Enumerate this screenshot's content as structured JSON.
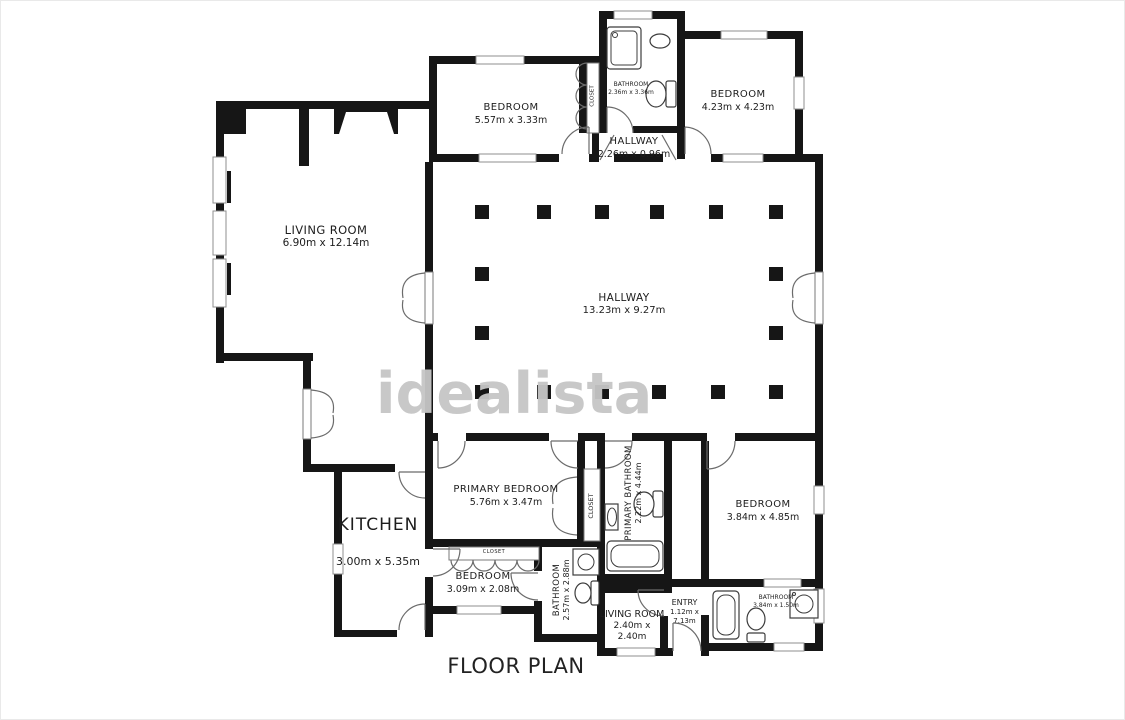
{
  "title": "FLOOR PLAN",
  "watermark": "idealista",
  "colors": {
    "wall": "#161616",
    "watermark": "#c6c6c6",
    "text": "#1d1d1d"
  },
  "rooms": {
    "living_room": {
      "name": "LIVING ROOM",
      "dims": "6.90m x 12.14m"
    },
    "bedroom_top": {
      "name": "BEDROOM",
      "dims": "5.57m x 3.33m"
    },
    "bathroom_top": {
      "name": "BATHROOM",
      "dims": "2.36m x 3.36m"
    },
    "closet_top": {
      "name": "CLOSET"
    },
    "hallway_top": {
      "name": "HALLWAY",
      "dims": "2.26m x 0.96m"
    },
    "bedroom_top_right": {
      "name": "BEDROOM",
      "dims": "4.23m x 4.23m"
    },
    "hallway_main": {
      "name": "HALLWAY",
      "dims": "13.23m x 9.27m"
    },
    "kitchen": {
      "name": "KITCHEN",
      "dims": "3.00m x 5.35m"
    },
    "primary_bedroom": {
      "name": "PRIMARY BEDROOM",
      "dims": "5.76m x 3.47m"
    },
    "closet_primary": {
      "name": "CLOSET"
    },
    "primary_bathroom": {
      "name": "PRIMARY BATHROOM",
      "dims": "2.22m x 4.44m"
    },
    "bedroom_right": {
      "name": "BEDROOM",
      "dims": "3.84m x 4.85m"
    },
    "closet_bedroom": {
      "name": "CLOSET"
    },
    "bedroom_small": {
      "name": "BEDROOM",
      "dims": "3.09m x 2.08m"
    },
    "bathroom_mid": {
      "name": "BATHROOM",
      "dims": "2.57m x 2.88m"
    },
    "living_room_small": {
      "name": "LIVING ROOM",
      "dims": "2.40m x 2.40m"
    },
    "entry": {
      "name": "ENTRY",
      "dims": "1.12m x 7.13m"
    },
    "bathroom_bottom": {
      "name": "BATHROOM",
      "dims": "3.84m x 1.50m"
    }
  }
}
